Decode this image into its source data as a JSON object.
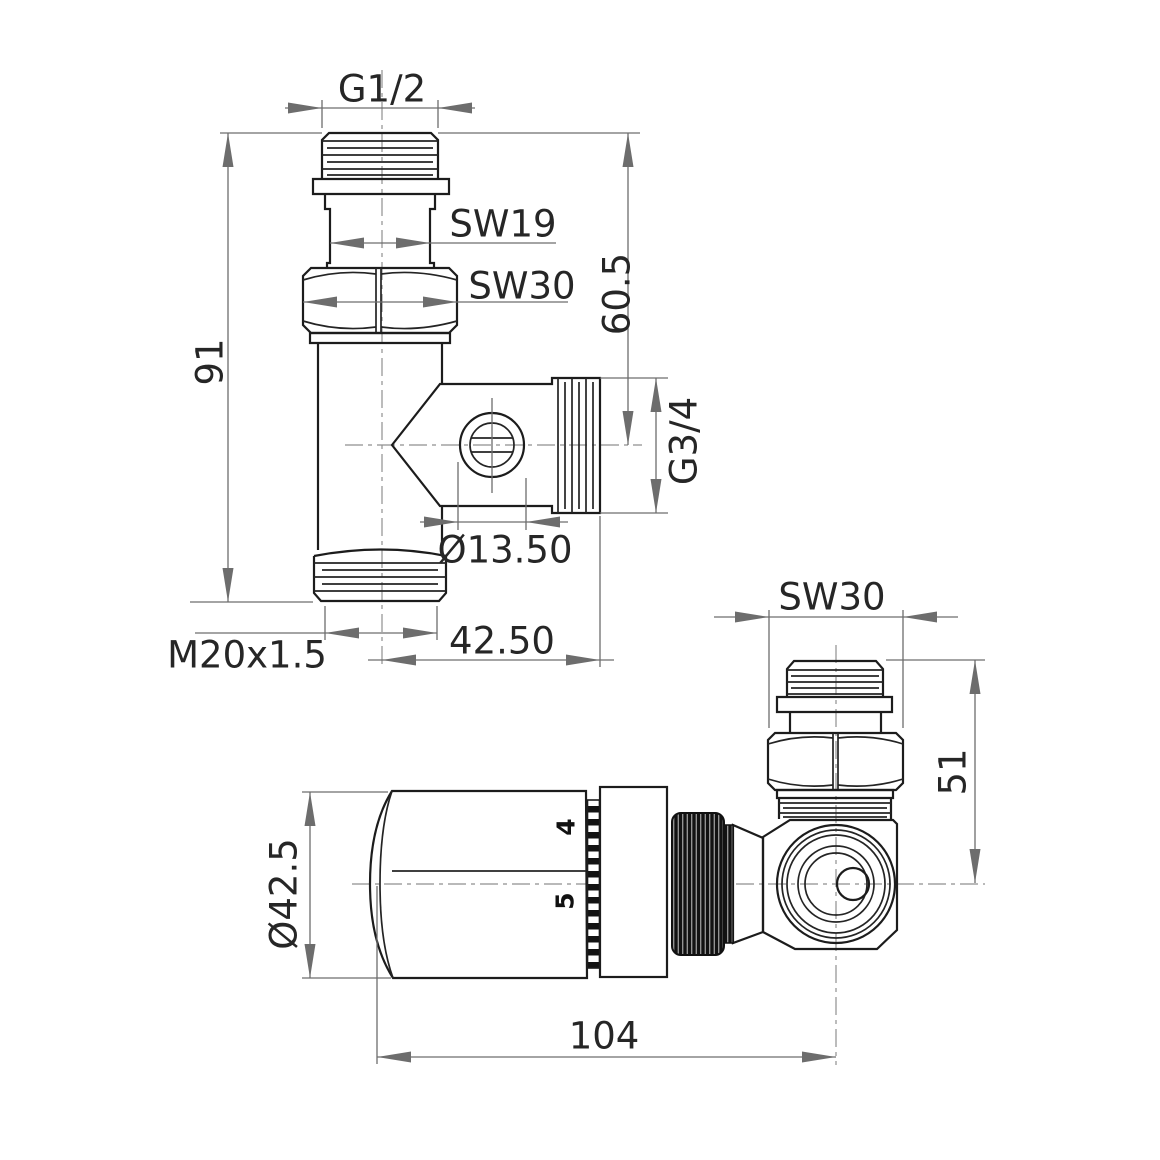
{
  "front_view": {
    "dim_top_thread": "G1/2",
    "dim_wrench_small": "SW19",
    "dim_wrench_large": "SW30",
    "dim_total_height": "91",
    "dim_outlet_height": "60.5",
    "dim_side_thread": "G3/4",
    "dim_bore": "Ø13.50",
    "dim_outlet_length": "42.50",
    "dim_bottom_thread": "M20x1.5"
  },
  "side_view": {
    "dim_wrench": "SW30",
    "dim_port_height": "51",
    "dim_head_diameter": "Ø42.5",
    "dim_total_length": "104",
    "scale_digit_upper": "4",
    "scale_digit_lower": "5"
  },
  "colors": {
    "outline": "#1c1c1c",
    "dimension": "#6d6d6d",
    "centerline": "#8f8f8f",
    "background": "#ffffff"
  }
}
